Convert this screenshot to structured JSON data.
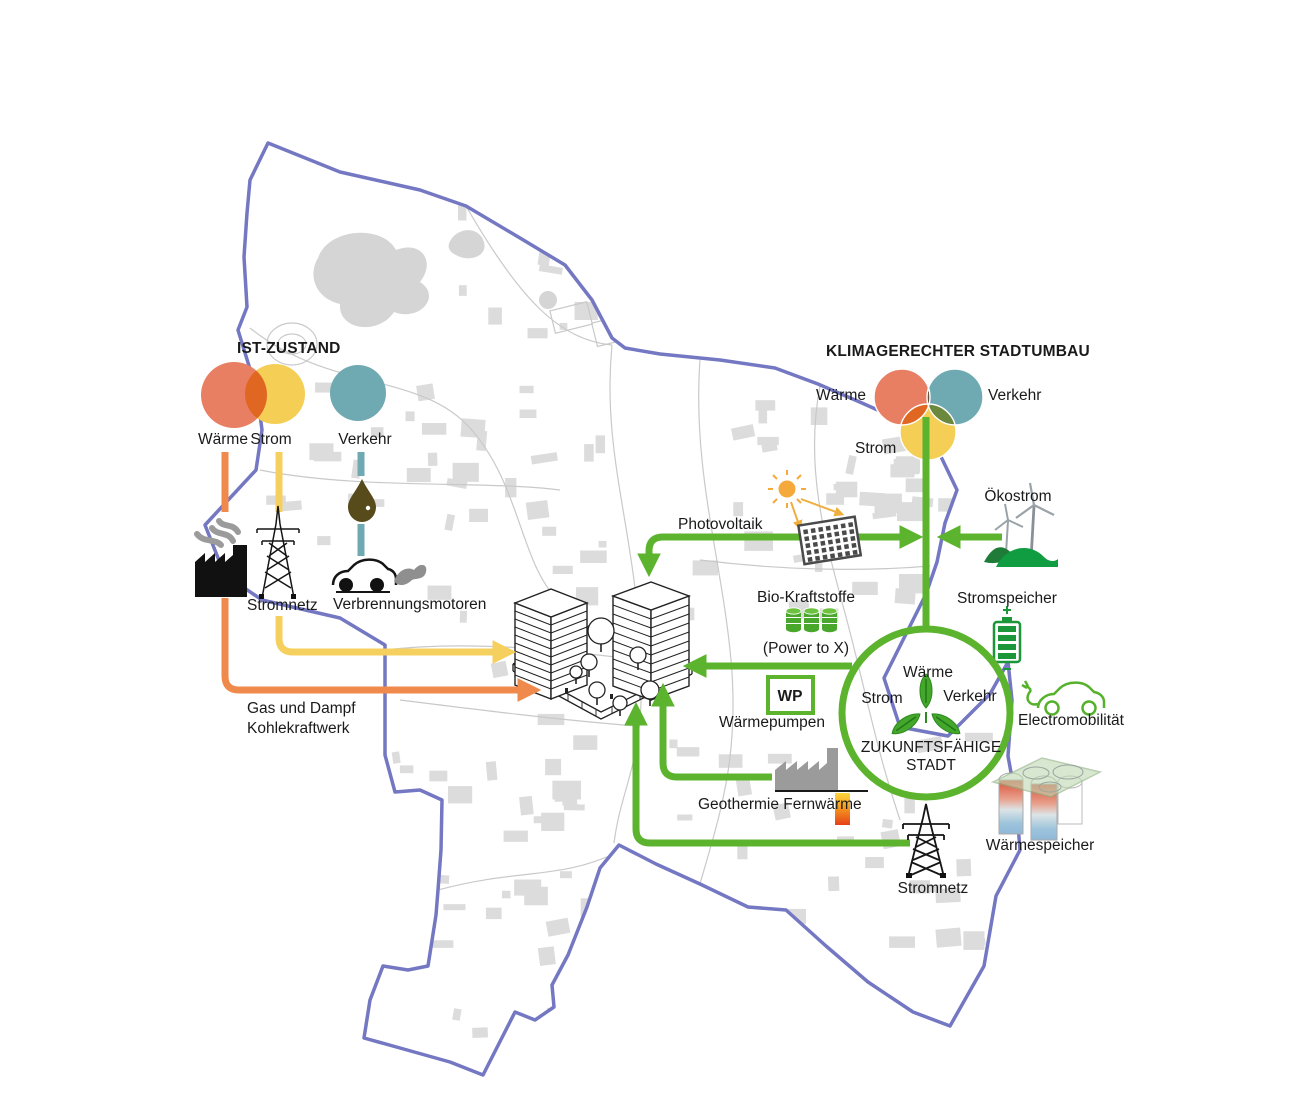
{
  "colors": {
    "green": "#5CB32D",
    "orange": "#F08A4C",
    "yellow_arrow": "#F6D05E",
    "waerme_red": "#E87F63",
    "strom_yellow": "#F5CE55",
    "verkehr_teal": "#6FA9B2",
    "boundary_purple": "#7477C2",
    "map_gray": "#DCDCDC",
    "oil_brown": "#574B1C",
    "battery_green": "#1B9638"
  },
  "ist": {
    "title": "IST-ZUSTAND",
    "legend": [
      {
        "label": "Wärme"
      },
      {
        "label": "Strom"
      },
      {
        "label": "Verkehr"
      }
    ],
    "stromnetz": "Stromnetz",
    "verbrennungsmotoren": "Verbrennungsmotoren",
    "kraftwerk1": "Gas und Dampf",
    "kraftwerk2": "Kohlekraftwerk"
  },
  "umbau": {
    "title": "KLIMAGERECHTER STADTUMBAU",
    "venn_waerme": "Wärme",
    "venn_verkehr": "Verkehr",
    "venn_strom": "Strom",
    "photovoltaik": "Photovoltaik",
    "oekostrom": "Ökostrom",
    "bio": "Bio-Kraftstoffe",
    "power_to_x": "(Power to X)",
    "wp": "WP",
    "waermepumpen": "Wärmepumpen",
    "geothermie": "Geothermie Fernwärme",
    "stromspeicher": "Stromspeicher",
    "electro": "Electromobilität",
    "waermespeicher": "Wärmespeicher",
    "stromnetz": "Stromnetz"
  },
  "stadt": {
    "waerme": "Wärme",
    "strom": "Strom",
    "verkehr": "Verkehr",
    "name1": "ZUKUNFTSFÄHIGE",
    "name2": "STADT"
  }
}
